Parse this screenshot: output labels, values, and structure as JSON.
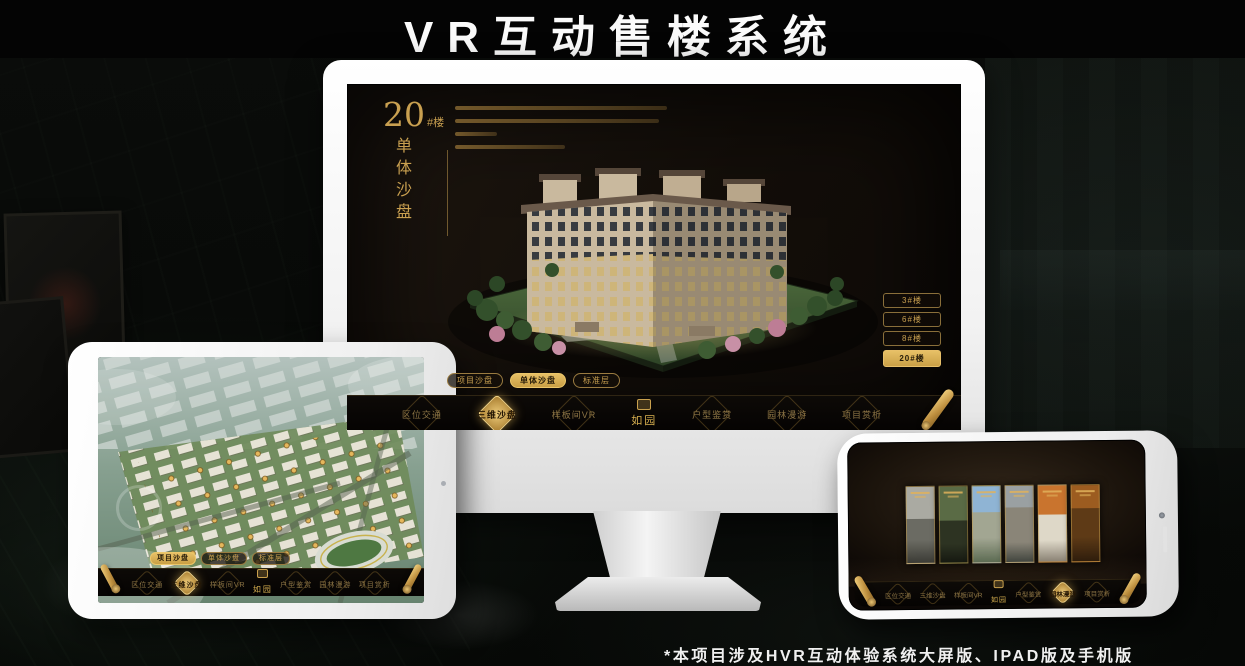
{
  "title": "VR互动售楼系统",
  "footnote": "*本项目涉及HVR互动体验系统大屏版、IPAD版及手机版",
  "colors": {
    "gold_accent": "#cda253",
    "gold_active": "#e7c066",
    "screen_bg": "#17100a",
    "device_white": "#ffffff"
  },
  "app": {
    "logo": "如园",
    "detail": {
      "number": "20",
      "suffix": "#楼",
      "vertical_title": "单体沙盘"
    },
    "floors": [
      "3#楼",
      "6#楼",
      "8#楼",
      "20#楼"
    ],
    "active_floor": "20#楼",
    "tabs": [
      "项目沙盘",
      "单体沙盘",
      "标准层"
    ],
    "monitor_active_tab": "单体沙盘",
    "tablet_active_tab": "项目沙盘",
    "nav": {
      "items": [
        "区位交通",
        "三维沙盘",
        "样板间VR",
        "户型鉴赏",
        "园林漫游",
        "项目赏析"
      ]
    },
    "monitor_active_nav": "三维沙盘",
    "tablet_active_nav": "三维沙盘",
    "phone_active_nav": "园林漫游"
  },
  "phone": {
    "gallery_panels": [
      "courtyard-bw",
      "interior-green",
      "tower-sky",
      "building-facade",
      "autumn-trees",
      "interior-warm"
    ]
  }
}
